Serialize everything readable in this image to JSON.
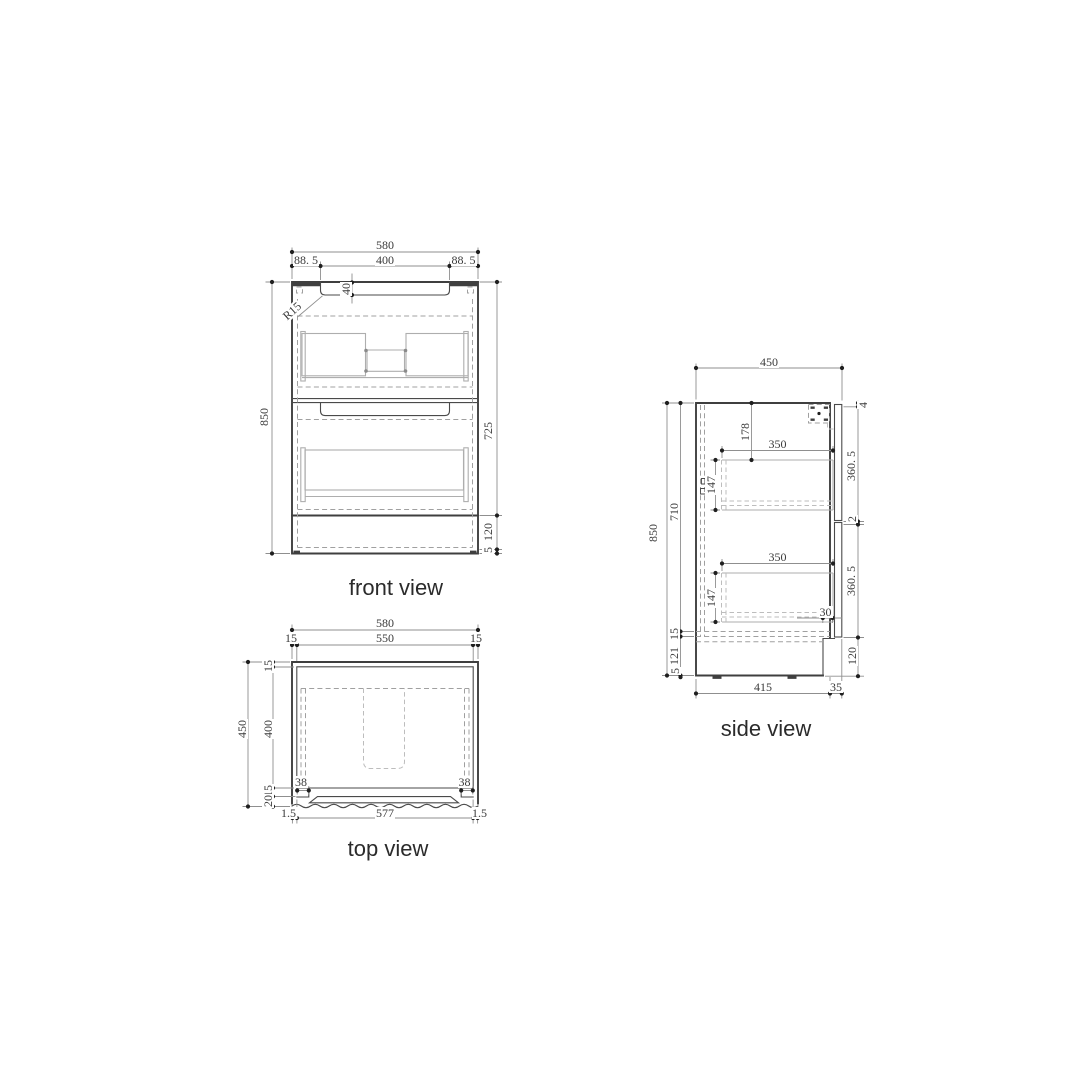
{
  "drawing": {
    "background": "#ffffff",
    "line_color": "#3f3f3f",
    "dim_color": "#8f8f8f"
  },
  "front_view": {
    "label": "front view",
    "dims": {
      "overall_width": "580",
      "left_offset": "88. 5",
      "handle_width": "400",
      "right_offset": "88. 5",
      "handle_depth": "40",
      "radius": "R15",
      "overall_height": "850",
      "body_height": "725",
      "kick_height": "120",
      "base_gap": "5"
    }
  },
  "top_view": {
    "label": "top view",
    "dims": {
      "overall_width": "580",
      "wall_left": "15",
      "inner_width": "550",
      "wall_right": "15",
      "overall_depth": "450",
      "back_wall": "15",
      "inner_depth": "400",
      "front_wall": "15",
      "front_edge": "20",
      "corner_left": "38",
      "corner_right": "38",
      "edge_left": "1.5",
      "bottom_width": "577",
      "edge_right": "1.5"
    }
  },
  "side_view": {
    "label": "side view",
    "dims": {
      "overall_depth": "450",
      "overall_height": "850",
      "carcass_height": "710",
      "bottom_panel": "15",
      "kick_inner": "121",
      "base_gap": "5",
      "top_to_drawer": "178",
      "drawer_depth_top": "350",
      "drawer_height_top": "147",
      "drawer_depth_bottom": "350",
      "drawer_height_bottom": "147",
      "recess": "30",
      "top_gap": "4",
      "front_top": "360. 5",
      "front_gap": "2",
      "front_bottom": "360. 5",
      "kick_height": "120",
      "base_depth": "415",
      "front_offset": "35"
    }
  }
}
